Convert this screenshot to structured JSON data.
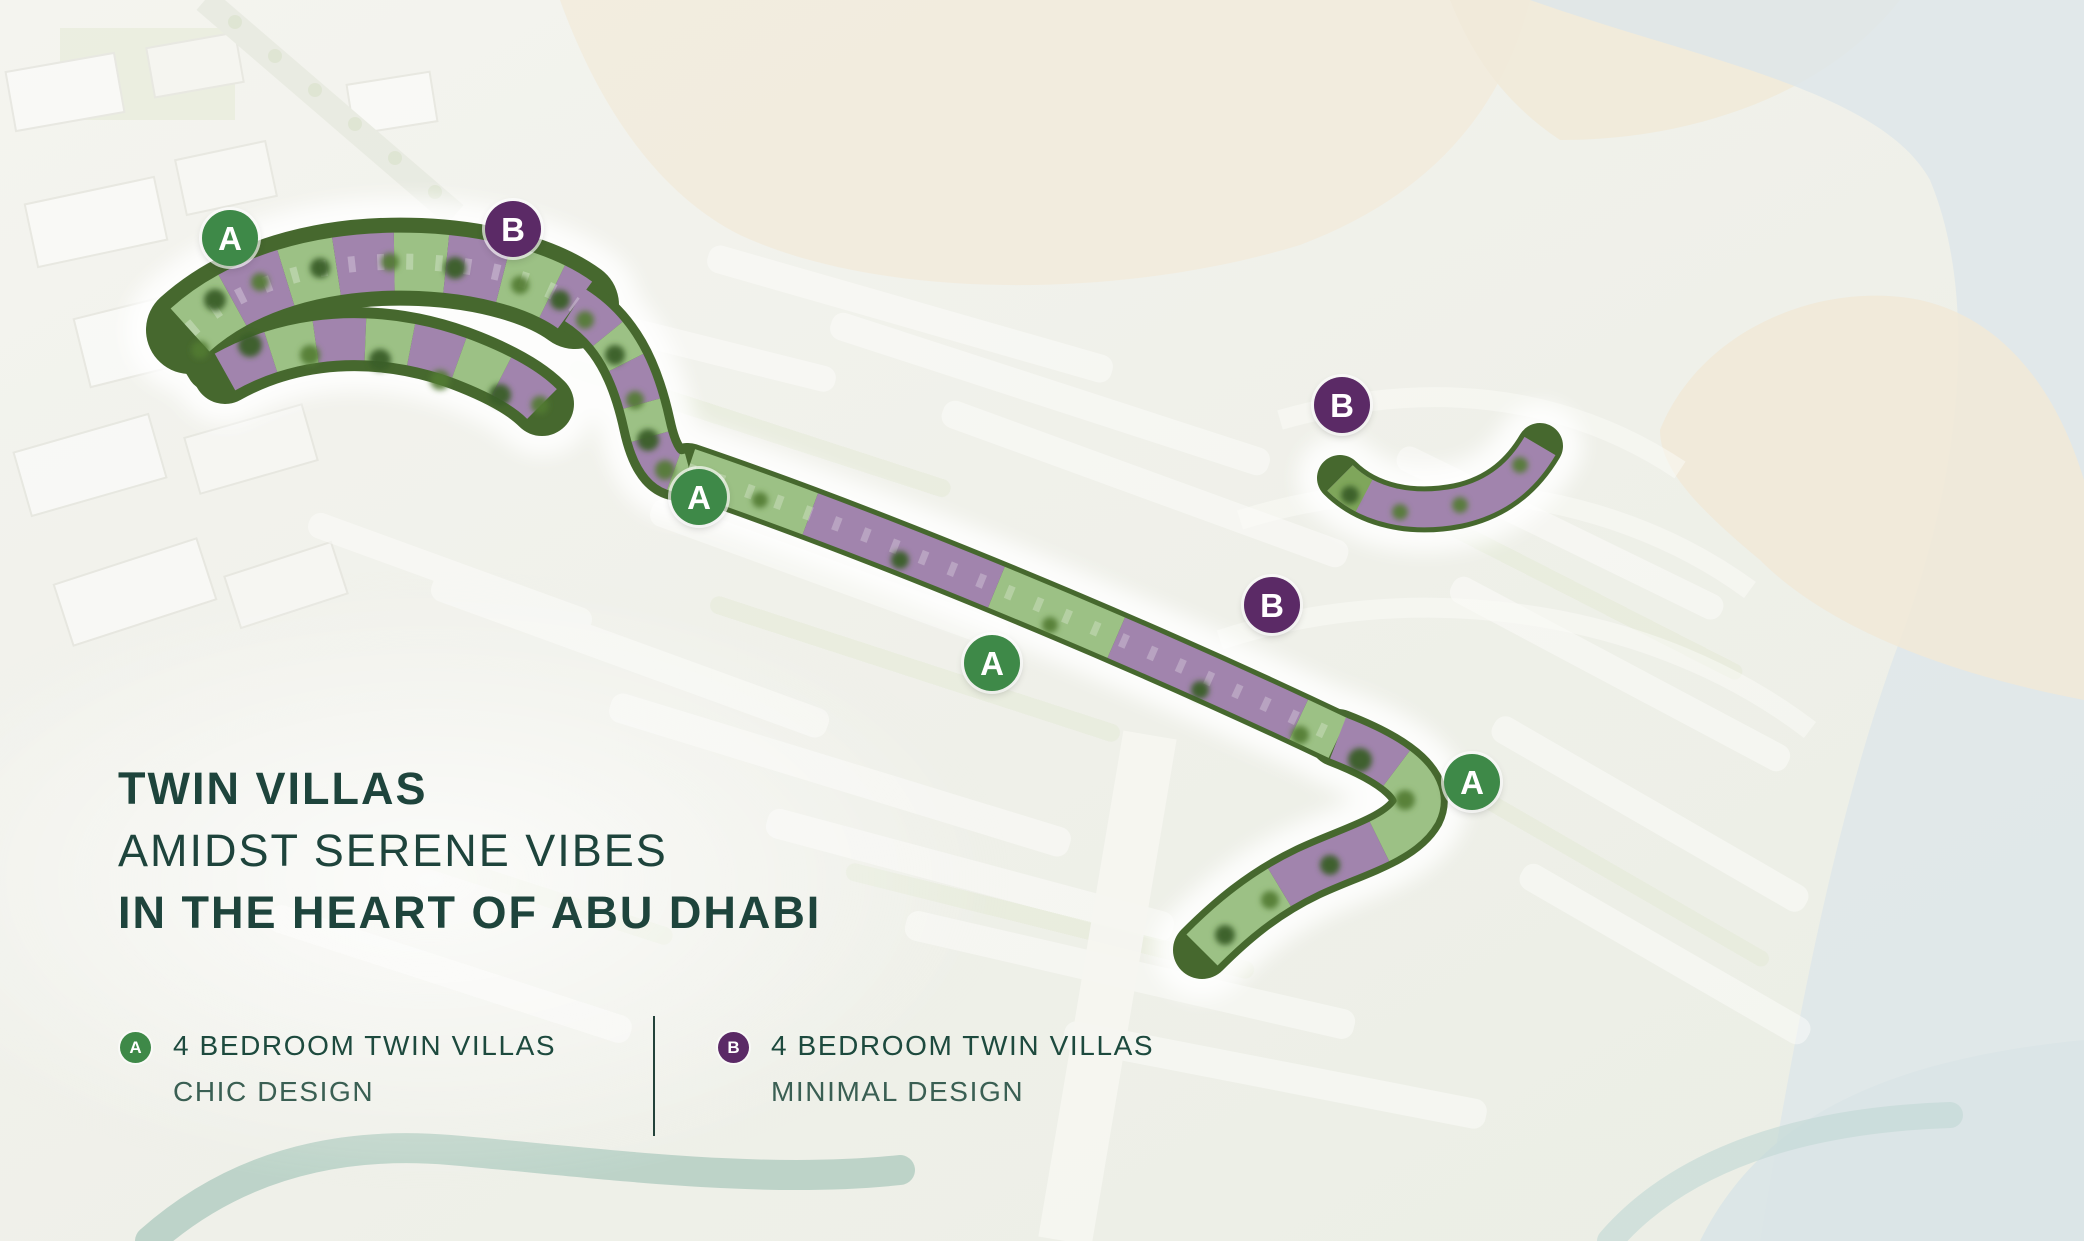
{
  "hero": {
    "title_line1": "TWIN VILLAS",
    "title_line2": "AMIDST SERENE VIBES",
    "title_line3": "IN THE HEART OF ABU DHABI"
  },
  "legend": {
    "items": [
      {
        "marker": "A",
        "color_key": "green",
        "line1": "4 BEDROOM TWIN VILLAS",
        "line2": "CHIC DESIGN"
      },
      {
        "marker": "B",
        "color_key": "purple",
        "line1": "4 BEDROOM TWIN VILLAS",
        "line2": "MINIMAL DESIGN"
      }
    ]
  },
  "map": {
    "markers": [
      {
        "label": "A",
        "color_key": "green",
        "x": 230,
        "y": 238
      },
      {
        "label": "B",
        "color_key": "purple",
        "x": 513,
        "y": 229
      },
      {
        "label": "A",
        "color_key": "green",
        "x": 699,
        "y": 497
      },
      {
        "label": "B",
        "color_key": "purple",
        "x": 1342,
        "y": 405
      },
      {
        "label": "B",
        "color_key": "purple",
        "x": 1272,
        "y": 605
      },
      {
        "label": "A",
        "color_key": "green",
        "x": 992,
        "y": 663
      },
      {
        "label": "A",
        "color_key": "green",
        "x": 1472,
        "y": 782
      }
    ]
  },
  "colors": {
    "green": "#3E8948",
    "purple": "#5B2A66",
    "title_text": "#1E443C",
    "legend_text": "#1D4A3E",
    "legend_subtext": "#3A5F53",
    "villa_green": "#9CC185",
    "villa_purple": "#A184AD",
    "tree_green": "#46682E",
    "water": "#DDE6EA",
    "sand": "#F2EBDC"
  }
}
